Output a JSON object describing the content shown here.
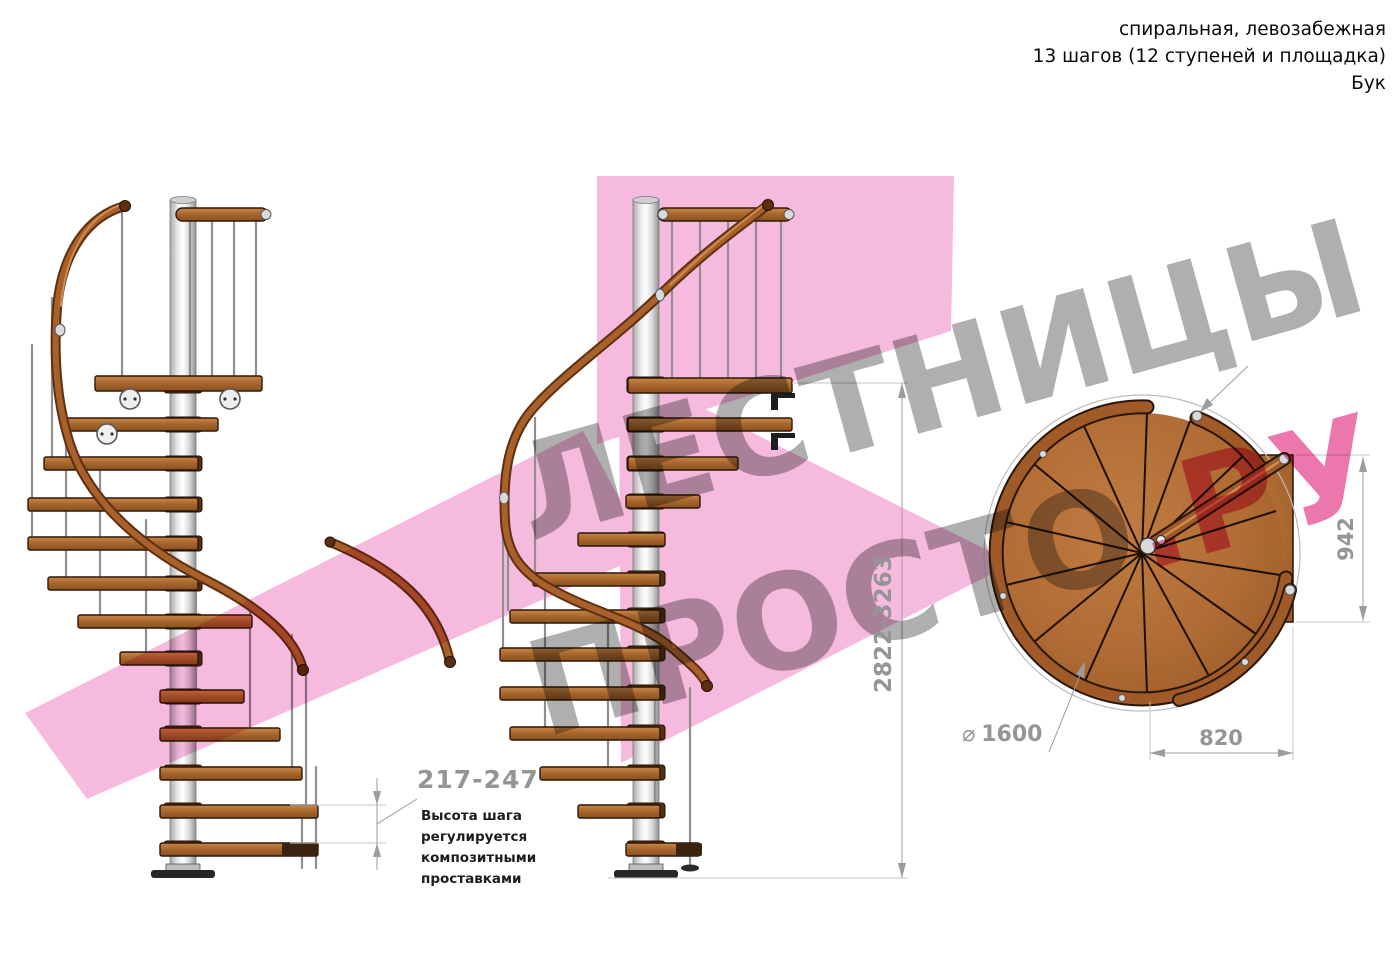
{
  "header": {
    "line1": "спиральная, левозабежная",
    "line2": "13 шагов (12 ступеней и площадка)",
    "line3": "Бук"
  },
  "dimensions": {
    "total_height": "2822-3263",
    "platform_depth": "942",
    "platform_width": "820",
    "diameter_symbol": "⌀",
    "diameter": "1600",
    "step_height": "217-247"
  },
  "annotation": {
    "line1": "Высота шага",
    "line2": "регулируется",
    "line3": "композитными",
    "line4": "проставками"
  },
  "watermark": {
    "line1": "ЛЕСТНИЦЫ",
    "line2": "ПРОСТО",
    "line2_suffix": ".РУ"
  },
  "colors": {
    "accent_pink": "#e75f9e",
    "watermark_gray": "#9e9e9e",
    "wood": "#a6652c",
    "dimension_gray": "#9c9c9c"
  }
}
